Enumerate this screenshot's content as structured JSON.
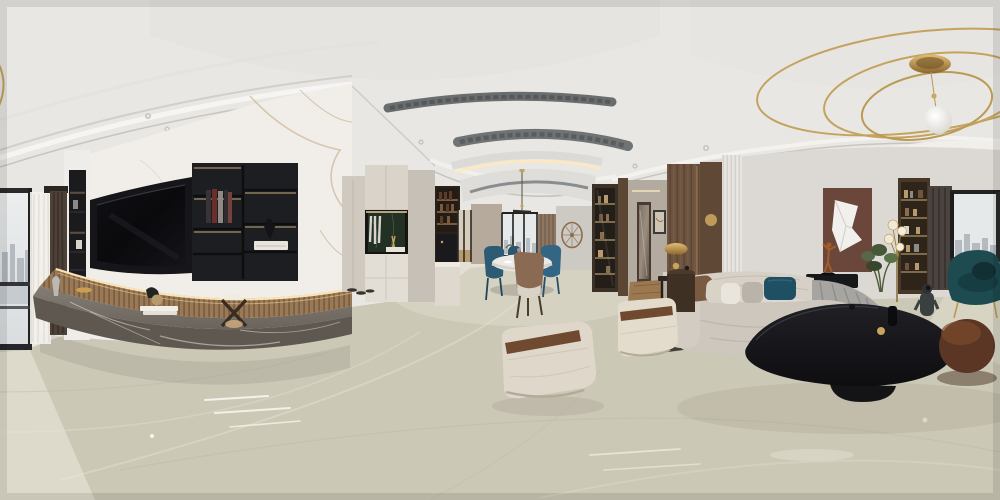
{
  "meta": {
    "title": "360-degree equirectangular panorama of a modern luxury living and dining room",
    "view": "indoor interior render, no visible text or UI"
  },
  "palette": {
    "ceiling": "#e9e7e3",
    "ceiling_shade": "#dbd9d5",
    "wall_white": "#efede9",
    "marble_wall": "#f1eeea",
    "marble_vein": "#c0a77f",
    "tv_black": "#0c0c0f",
    "tv_recess": "#16161a",
    "cabinet_black": "#1d1e22",
    "led_warm": "#ffe9bd",
    "wood_slat": "#a5815c",
    "bench_top": "#7b746c",
    "bench_face": "#5f5851",
    "bench_vein": "#d8d2c9",
    "floor": "#ccc8b6",
    "floor_far": "#dad6c8",
    "foyer_cabinet": "#d9d3ca",
    "foyer_cabinet_low": "#e2ddd5",
    "niche_green": "#233024",
    "kitchen_wall": "#b6aa9c",
    "window_sky": "#e6e9ea",
    "city_tone": "#b4bac0",
    "stripe_panel": "#8d7763",
    "wall_taupe": "#cdc9c3",
    "display_wood": "#3c3126",
    "hall_wood": "#6e5440",
    "hall_wall": "#b3aaa0",
    "fluted_panel": "#e8e5e0",
    "brown_panel": "#6b463a",
    "sofa_cream": "#cdc7bd",
    "sofa_back": "#d6d0c7",
    "sofa_gray": "#a7a5a1",
    "pillow_teal": "#1f4f63",
    "pillow_brown": "#7b5a42",
    "table_black": "#17171a",
    "pouf_brown": "#5b3625",
    "chair_teal": "#1d4b4f",
    "dining_chair_teal": "#2d5b74",
    "dining_chair_brown": "#8a6a52",
    "ottoman_cream": "#dfd8ca",
    "strap_brown": "#6f4a30",
    "gold": "#c4a35f",
    "bronze": "#a35c28",
    "curtain_brown": "#4e4238",
    "curtain_sheer": "#f3f1ec",
    "curtain_right": "#4b4340"
  },
  "scene": {
    "ceiling_objects": [
      "gold-ring-chandelier",
      "chandelier-globe",
      "ac-vent-1",
      "ac-vent-2",
      "recessed-spotlights",
      "cove-lit-tray",
      "pendant-lamp",
      "crown-molding-arcs"
    ],
    "left_zone": [
      "city-window",
      "sheer-curtain",
      "brown-curtain",
      "black-niche-shelf",
      "marble-feature-wall",
      "tv-recess",
      "tv-screen",
      "black-shelf-unit",
      "books",
      "wood-slat-band",
      "stone-bench",
      "bench-decor"
    ],
    "center_zone": [
      "foyer-cabinets",
      "green-marble-niche",
      "wine-shelf",
      "coffee-station",
      "glass-door",
      "dining-window",
      "round-dining-table",
      "blue-velvet-chairs",
      "accent-chair",
      "round-wall-art",
      "display-cabinet"
    ],
    "hallway": [
      "glass-display-cabinet",
      "hallway-opening",
      "mirror-door",
      "framed-art",
      "walnut-column",
      "console-table",
      "brass-mushroom-lamp"
    ],
    "right_zone": [
      "fluted-panel",
      "brown-art-panel",
      "folded-paper-art",
      "dancer-sculpture",
      "curved-sectional-sofa",
      "throw-pillows",
      "black-organic-coffee-table",
      "astronaut-figurine",
      "leather-ottomans",
      "round-brown-pouf",
      "teal-armchair",
      "floor-lamp",
      "bookshelf",
      "city-window-right",
      "indoor-plant"
    ],
    "floor": [
      "glossy-marble-floor",
      "specular-streaks",
      "window-light-patches"
    ]
  }
}
